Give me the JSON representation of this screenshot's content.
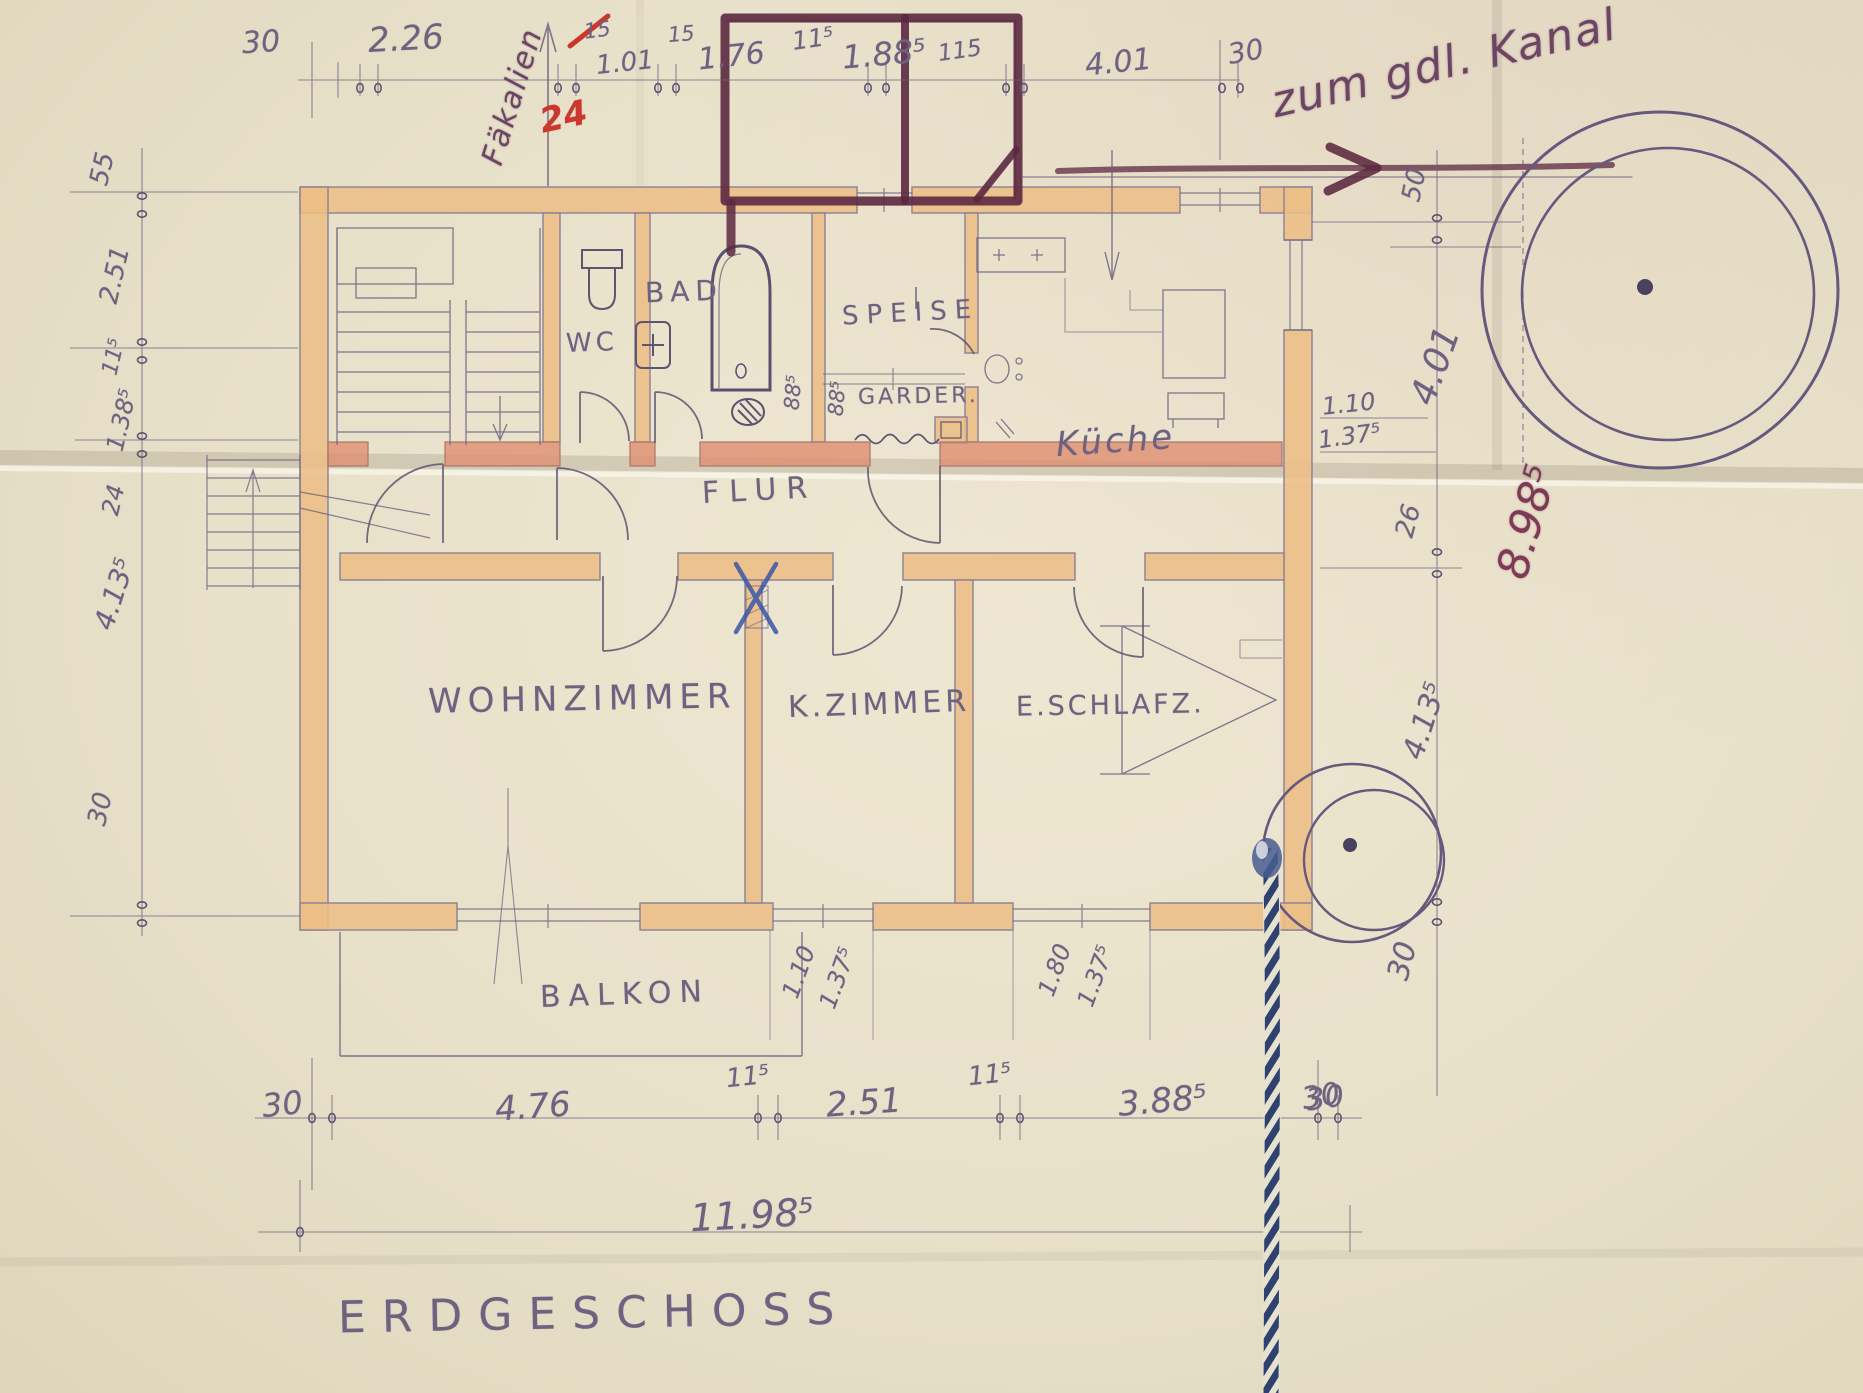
{
  "meta": {
    "drawing_title": "ERDGESCHOSS",
    "type": "hand-drawn ground floor plan"
  },
  "colors": {
    "paper": "#e8e1ca",
    "wall": "#ecbe86",
    "wall_accent": "#df8f70",
    "pencil": "#6d6280",
    "crayon": "#5c2840",
    "red_mark": "#c9372e",
    "blue_ink": "#3a56a8",
    "rope": "#2e4170"
  },
  "title": {
    "floor_label": "ERDGESCHOSS"
  },
  "annotations": {
    "kanal_note": "zum gdl. Kanal",
    "faekalien_note": "Fäkalien",
    "red_mark": "24"
  },
  "rooms": {
    "wc": "WC",
    "bad": "BAD",
    "speise": "SPEISE",
    "garderobe": "GARDER.",
    "kueche": "Küche",
    "flur": "FLUR",
    "wohnzimmer": "WOHNZIMMER",
    "kzimmer": "K.ZIMMER",
    "eschlafz": "E.SCHLAFZ.",
    "balkon": "BALKON"
  },
  "dims": {
    "top": [
      "30",
      "2.26",
      "15",
      "1.01",
      "15",
      "1.76",
      "11⁵",
      "1.88⁵",
      "115",
      "4.01",
      "30"
    ],
    "bottom": [
      "30",
      "4.76",
      "11⁵",
      "2.51",
      "11⁵",
      "3.88⁵",
      "30"
    ],
    "bottom_total": "11.98⁵",
    "left": [
      "55",
      "2.51",
      "11⁵",
      "1.38⁵",
      "24",
      "4.13⁵",
      "30"
    ],
    "right": [
      "50",
      "4.01",
      "26",
      "8.98⁵",
      "4.13⁵",
      "30",
      "30"
    ],
    "interior": [
      "88⁵",
      "88⁵",
      "1.10",
      "1.37⁵",
      "1.10",
      "1.37⁵",
      "1.80",
      "1.37⁵"
    ]
  }
}
